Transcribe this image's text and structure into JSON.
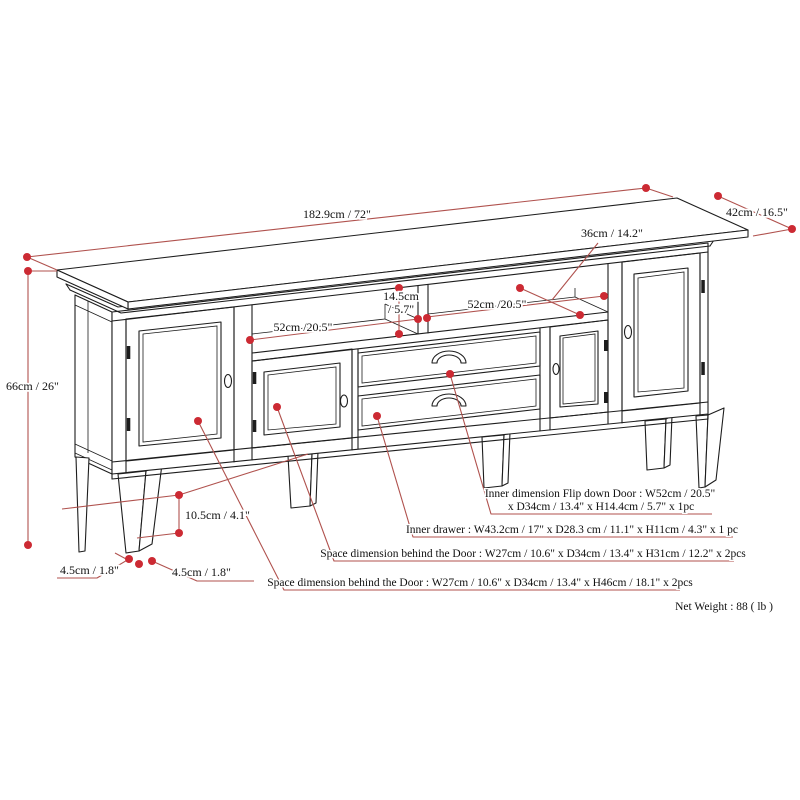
{
  "dimensions": {
    "top_width": "182.9cm / 72\"",
    "top_depth": "42cm / 16.5\"",
    "overall_height": "66cm / 26\"",
    "shelf_depth": "36cm / 14.2\"",
    "shelf_opening_height_cm": "14.5cm",
    "shelf_opening_height_in": "/ 5.7\"",
    "shelf_opening_width_left": "52cm /20.5\"",
    "shelf_opening_width_right": "52cm /20.5\"",
    "base_clearance": "10.5cm / 4.1\"",
    "foot_width": "4.5cm / 1.8\"",
    "foot_depth": "4.5cm / 1.8\""
  },
  "notes": {
    "flip_down_door_line1": "Inner dimension Flip down Door : W52cm / 20.5\"",
    "flip_down_door_line2": "x D34cm / 13.4\" x H14.4cm / 5.7\" x 1pc",
    "inner_drawer": "Inner drawer : W43.2cm / 17\" x D28.3 cm / 11.1\"  x H11cm / 4.3\" x 1 pc",
    "space_behind_door_h31": "Space dimension behind the Door : W27cm / 10.6\" x D34cm / 13.4\" x H31cm / 12.2\" x 2pcs",
    "space_behind_door_h46": "Space dimension behind the Door : W27cm / 10.6\" x D34cm / 13.4\" x H46cm / 18.1\" x 2pcs",
    "net_weight": "Net Weight : 88 ( lb )"
  },
  "colors": {
    "ink": "#1d1d1d",
    "dimension_line": "#b0524e",
    "dimension_dot": "#cc2a33",
    "text": "#111111",
    "background": "#ffffff"
  }
}
